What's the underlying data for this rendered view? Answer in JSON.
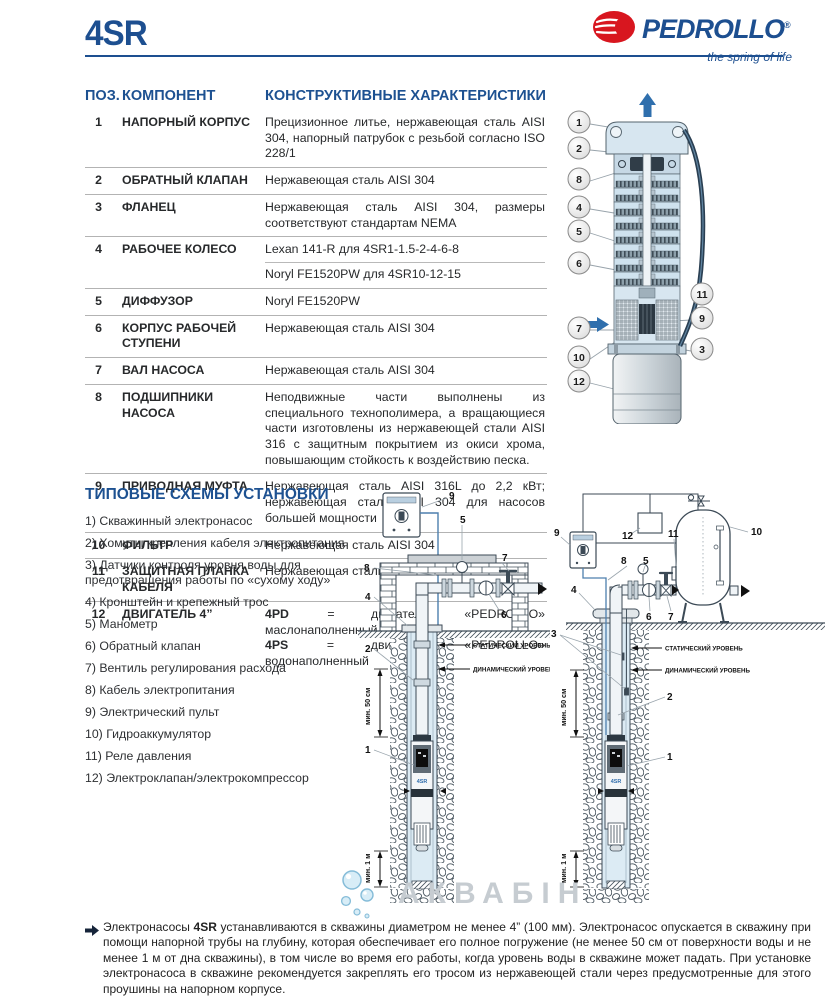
{
  "page": {
    "model": "4SR"
  },
  "brand": {
    "name": "PEDROLLO",
    "reg": "®",
    "tagline": "the spring of life"
  },
  "components_table": {
    "headers": {
      "pos": "ПОЗ.",
      "component": "КОМПОНЕНТ",
      "characteristics": "КОНСТРУКТИВНЫЕ ХАРАКТЕРИСТИКИ"
    },
    "rows": [
      {
        "pos": "1",
        "component": "НАПОРНЫЙ КОРПУС",
        "text": "Прецизионное литье, нержавеющая сталь AISI 304, напорный патрубок с резьбой согласно ISO 228/1"
      },
      {
        "pos": "2",
        "component": "ОБРАТНЫЙ КЛАПАН",
        "text": "Нержавеющая сталь AISI 304"
      },
      {
        "pos": "3",
        "component": "ФЛАНЕЦ",
        "text": "Нержавеющая сталь AISI 304, размеры соответствуют стандартам NEMA"
      },
      {
        "pos": "4",
        "component": "РАБОЧЕЕ КОЛЕСО",
        "line1": "Lexan 141-R для 4SR1-1.5-2-4-6-8",
        "line2": "Noryl FE1520PW для 4SR10-12-15"
      },
      {
        "pos": "5",
        "component": "ДИФФУЗОР",
        "text": "Noryl FE1520PW"
      },
      {
        "pos": "6",
        "component": "КОРПУС РАБОЧЕЙ СТУПЕНИ",
        "text": "Нержавеющая сталь AISI 304"
      },
      {
        "pos": "7",
        "component": "ВАЛ НАСОСА",
        "text": "Нержавеющая сталь AISI 304"
      },
      {
        "pos": "8",
        "component": "ПОДШИПНИКИ НАСОСА",
        "text": "Неподвижные части выполнены из специального технополимера, а вращающиеся части изготовлены из нержавеющей стали AISI 316 с защитным покрытием из окиси хрома, повышающим стойкость к воздействию песка."
      },
      {
        "pos": "9",
        "component": "ПРИВОДНАЯ МУФТА",
        "text": "Нержавеющая сталь AISI 316L до 2,2 кВт; нержавеющая сталь AISI 304 для насосов большей мощности"
      },
      {
        "pos": "10",
        "component": "ФИЛЬТР",
        "text": "Нержавеющая сталь AISI 304"
      },
      {
        "pos": "11",
        "component": "ЗАЩИТНАЯ ПЛАНКА КАБЕЛЯ",
        "text": "Нержавеющая сталь AISI 304"
      },
      {
        "pos": "12",
        "component": "ДВИГАТЕЛЬ 4”",
        "motor1_code": "4PD",
        "motor1_text": " = двигатель «PEDROLLO» маслонаполненный",
        "motor2_code": "4PS",
        "motor2_text": " = двигатель «PEDROLLO» водонаполненный"
      }
    ]
  },
  "pump_diagram": {
    "callouts": [
      "1",
      "2",
      "8",
      "4",
      "5",
      "6",
      "7",
      "10",
      "12",
      "11",
      "9",
      "3"
    ]
  },
  "install": {
    "title": "ТИПОВЫЕ СХЕМЫ УСТАНОВКИ",
    "items": [
      "1) Скважинный электронасос",
      "2) Хомуты крепления кабеля электропитания",
      "3) Датчики контроля уровня воды для предотвращения работы по «сухому ходу»",
      "4) Кронштейн и крепежный трос",
      "5) Манометр",
      "6) Обратный клапан",
      "7) Вентиль регулирования расхода",
      "8) Кабель электропитания",
      "9) Электрический пульт",
      "10) Гидроаккумулятор",
      "11) Реле давления",
      "12) Электроклапан/электрокомпрессор"
    ]
  },
  "diagrams": {
    "pump_label": "4SR",
    "static_level": "СТАТИЧЕСКИЙ УРОВЕНЬ",
    "dynamic_level": "ДИНАМИЧЕСКИЙ УРОВЕНЬ",
    "min_50": "мин. 50 см",
    "min_1m": "мин. 1 м",
    "a": {
      "n1": "1",
      "n2": "2",
      "n4": "4",
      "n5": "5",
      "n6": "6",
      "n7": "7",
      "n8": "8",
      "n9": "9"
    },
    "b": {
      "n1": "1",
      "n2": "2",
      "n3": "3",
      "n4": "4",
      "n5": "5",
      "n6": "6",
      "n7": "7",
      "n8": "8",
      "n9": "9",
      "n10": "10",
      "n11": "11",
      "n12": "12"
    }
  },
  "watermark": "АКВАБІН",
  "footer": {
    "prefix": "Электронасосы ",
    "model": "4SR",
    "text": " устанавливаются в скважины диаметром не менее 4” (100 мм). Электронасос опускается в скважину при помощи напорной трубы на глубину, которая обеспечивает его полное погружение (не менее 50 см от поверхности воды и не менее 1 м от дна скважины), в том числе во время его работы, когда уровень воды в скважине может падать. При установке электронасоса в скважине рекомендуется закреплять его тросом из нержавеющей стали через предусмотренные для этого проушины на напорном корпусе."
  },
  "colors": {
    "accent": "#1d4f90",
    "brand_red": "#d8161f",
    "text": "#27292b",
    "rule_gray": "#b3b3b3",
    "water": "#dcebf4",
    "arrow_blue": "#2f6fad"
  }
}
